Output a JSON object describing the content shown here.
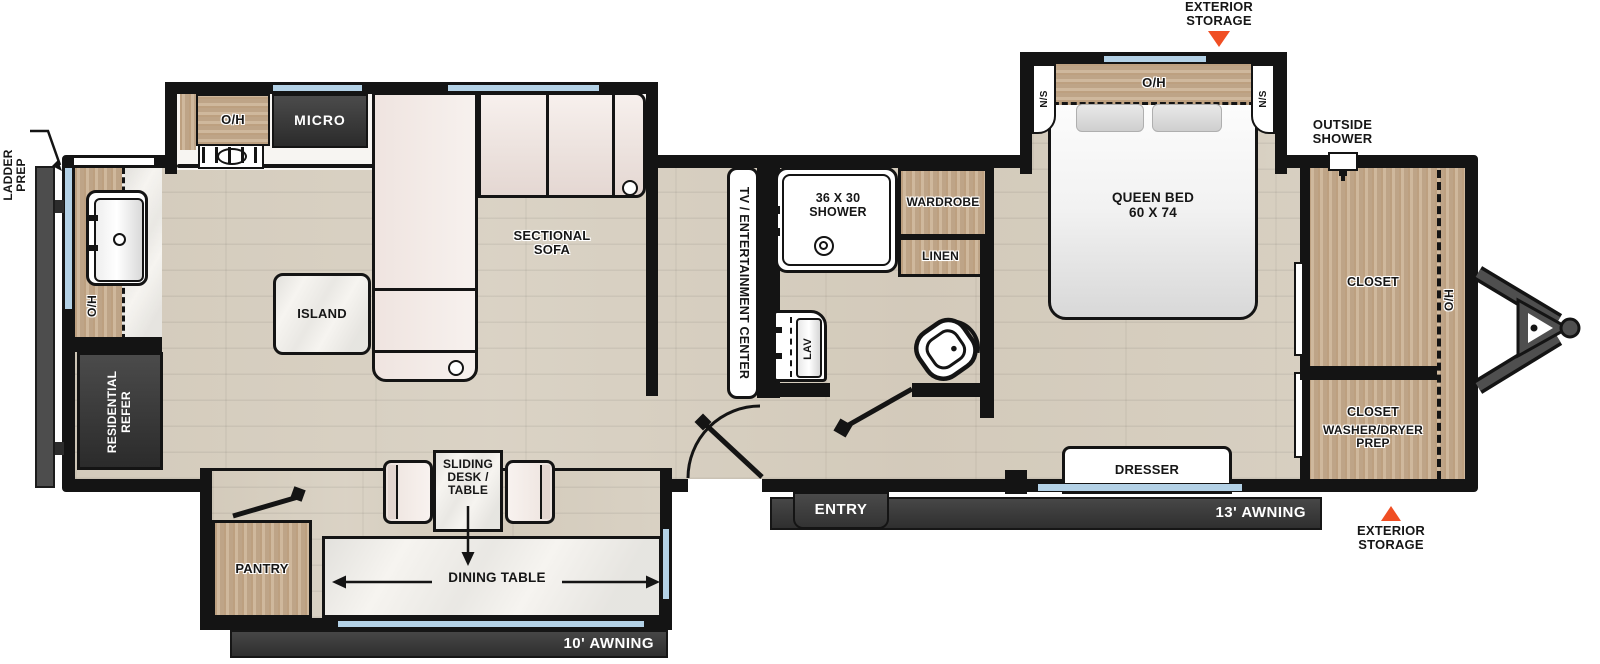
{
  "colors": {
    "wall_black": "#141414",
    "accent_orange": "#F04E23",
    "window_blue": "#B3D1E6",
    "wood_tan": "#C8AD8E",
    "floor_plank": "#DCD5C8",
    "dark_fixture": "#3A3A3A"
  },
  "labels": {
    "ladder_prep": {
      "l1": "LADDER",
      "l2": "PREP"
    },
    "rear_oh": "O/H",
    "refer": {
      "l1": "RESIDENTIAL",
      "l2": "REFER"
    },
    "kitchen_oh": "O/H",
    "micro": "MICRO",
    "sectional_sofa": {
      "l1": "SECTIONAL",
      "l2": "SOFA"
    },
    "island": "ISLAND",
    "tv_center": "TV / ENTERTAINMENT CENTER",
    "shower": {
      "l1": "36 X 30",
      "l2": "SHOWER"
    },
    "wardrobe": "WARDROBE",
    "linen": "LINEN",
    "lav": "LAV",
    "pantry": "PANTRY",
    "sliding_desk": {
      "l1": "SLIDING",
      "l2": "DESK /",
      "l3": "TABLE"
    },
    "dining_table": "DINING TABLE",
    "awning_10": "10' AWNING",
    "entry": "ENTRY",
    "awning_13": "13' AWNING",
    "exterior_storage_top": {
      "l1": "EXTERIOR",
      "l2": "STORAGE"
    },
    "exterior_storage_front": {
      "l1": "EXTERIOR",
      "l2": "STORAGE"
    },
    "outside_shower": {
      "l1": "OUTSIDE",
      "l2": "SHOWER"
    },
    "ns_left": "N/S",
    "ns_right": "N/S",
    "bedroom_oh": "O/H",
    "queen_bed": {
      "l1": "QUEEN BED",
      "l2": "60 X 74"
    },
    "dresser": "DRESSER",
    "closet_top": "CLOSET",
    "closet_bottom": {
      "l1": "CLOSET",
      "l2": "WASHER/DRYER",
      "l3": "PREP"
    },
    "front_oh": "O/H"
  }
}
